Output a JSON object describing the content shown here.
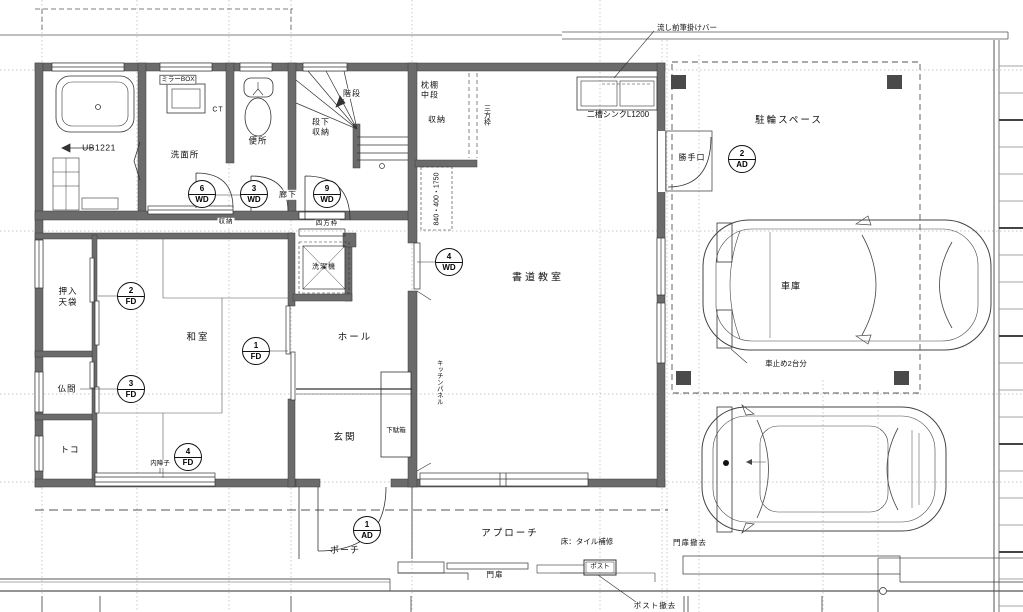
{
  "labels": {
    "ub": "UB1221",
    "senmenjo": "洗面所",
    "benjo": "便所",
    "mirror_box": "ミラーBOX",
    "ct": "CT",
    "kaidan": "階段",
    "danshita": "段下\n収納",
    "makuradana": "枕棚\n中段",
    "shuno_kaidan": "収納",
    "sanpo": "三方枠",
    "dims": "840・400・1750",
    "roka": "廊下",
    "shuno_small": "収納",
    "shiho": "四方枠",
    "sentakuki": "洗濯機",
    "nagashi_bar": "流し前筆掛けバー",
    "nisou_sink": "二槽シンクL1200",
    "chuurin": "駐輪スペース",
    "katteguchi": "勝手口",
    "shodo": "書道教室",
    "kitchen_panel": "キッチンパネル",
    "washitsu": "和室",
    "oshiire": "押入\n天袋",
    "butsuma": "仏間",
    "toko": "トコ",
    "uchishoji": "内障子",
    "hall": "ホール",
    "genkan": "玄関",
    "getabako": "下駄箱",
    "porch": "ポーチ",
    "approach": "アプローチ",
    "yuka_tile": "床：タイル補修",
    "monpi": "門扉",
    "monpi_tekkyo": "門扉撤去",
    "post": "ポスト",
    "post_tekkyo": "ポスト撤去",
    "shako": "車庫",
    "kurumadome": "車止め2台分"
  },
  "symbols": {
    "wd6": {
      "num": "6",
      "type": "WD"
    },
    "wd3": {
      "num": "3",
      "type": "WD"
    },
    "wd9": {
      "num": "9",
      "type": "WD"
    },
    "wd4": {
      "num": "4",
      "type": "WD"
    },
    "fd1": {
      "num": "1",
      "type": "FD"
    },
    "fd2": {
      "num": "2",
      "type": "FD"
    },
    "fd3": {
      "num": "3",
      "type": "FD"
    },
    "fd4": {
      "num": "4",
      "type": "FD"
    },
    "ad1": {
      "num": "1",
      "type": "AD"
    },
    "ad2": {
      "num": "2",
      "type": "AD"
    }
  },
  "colors": {
    "wall": "#6b6b6b",
    "line": "#333333",
    "grid": "#b5b5b5",
    "background": "#ffffff"
  }
}
